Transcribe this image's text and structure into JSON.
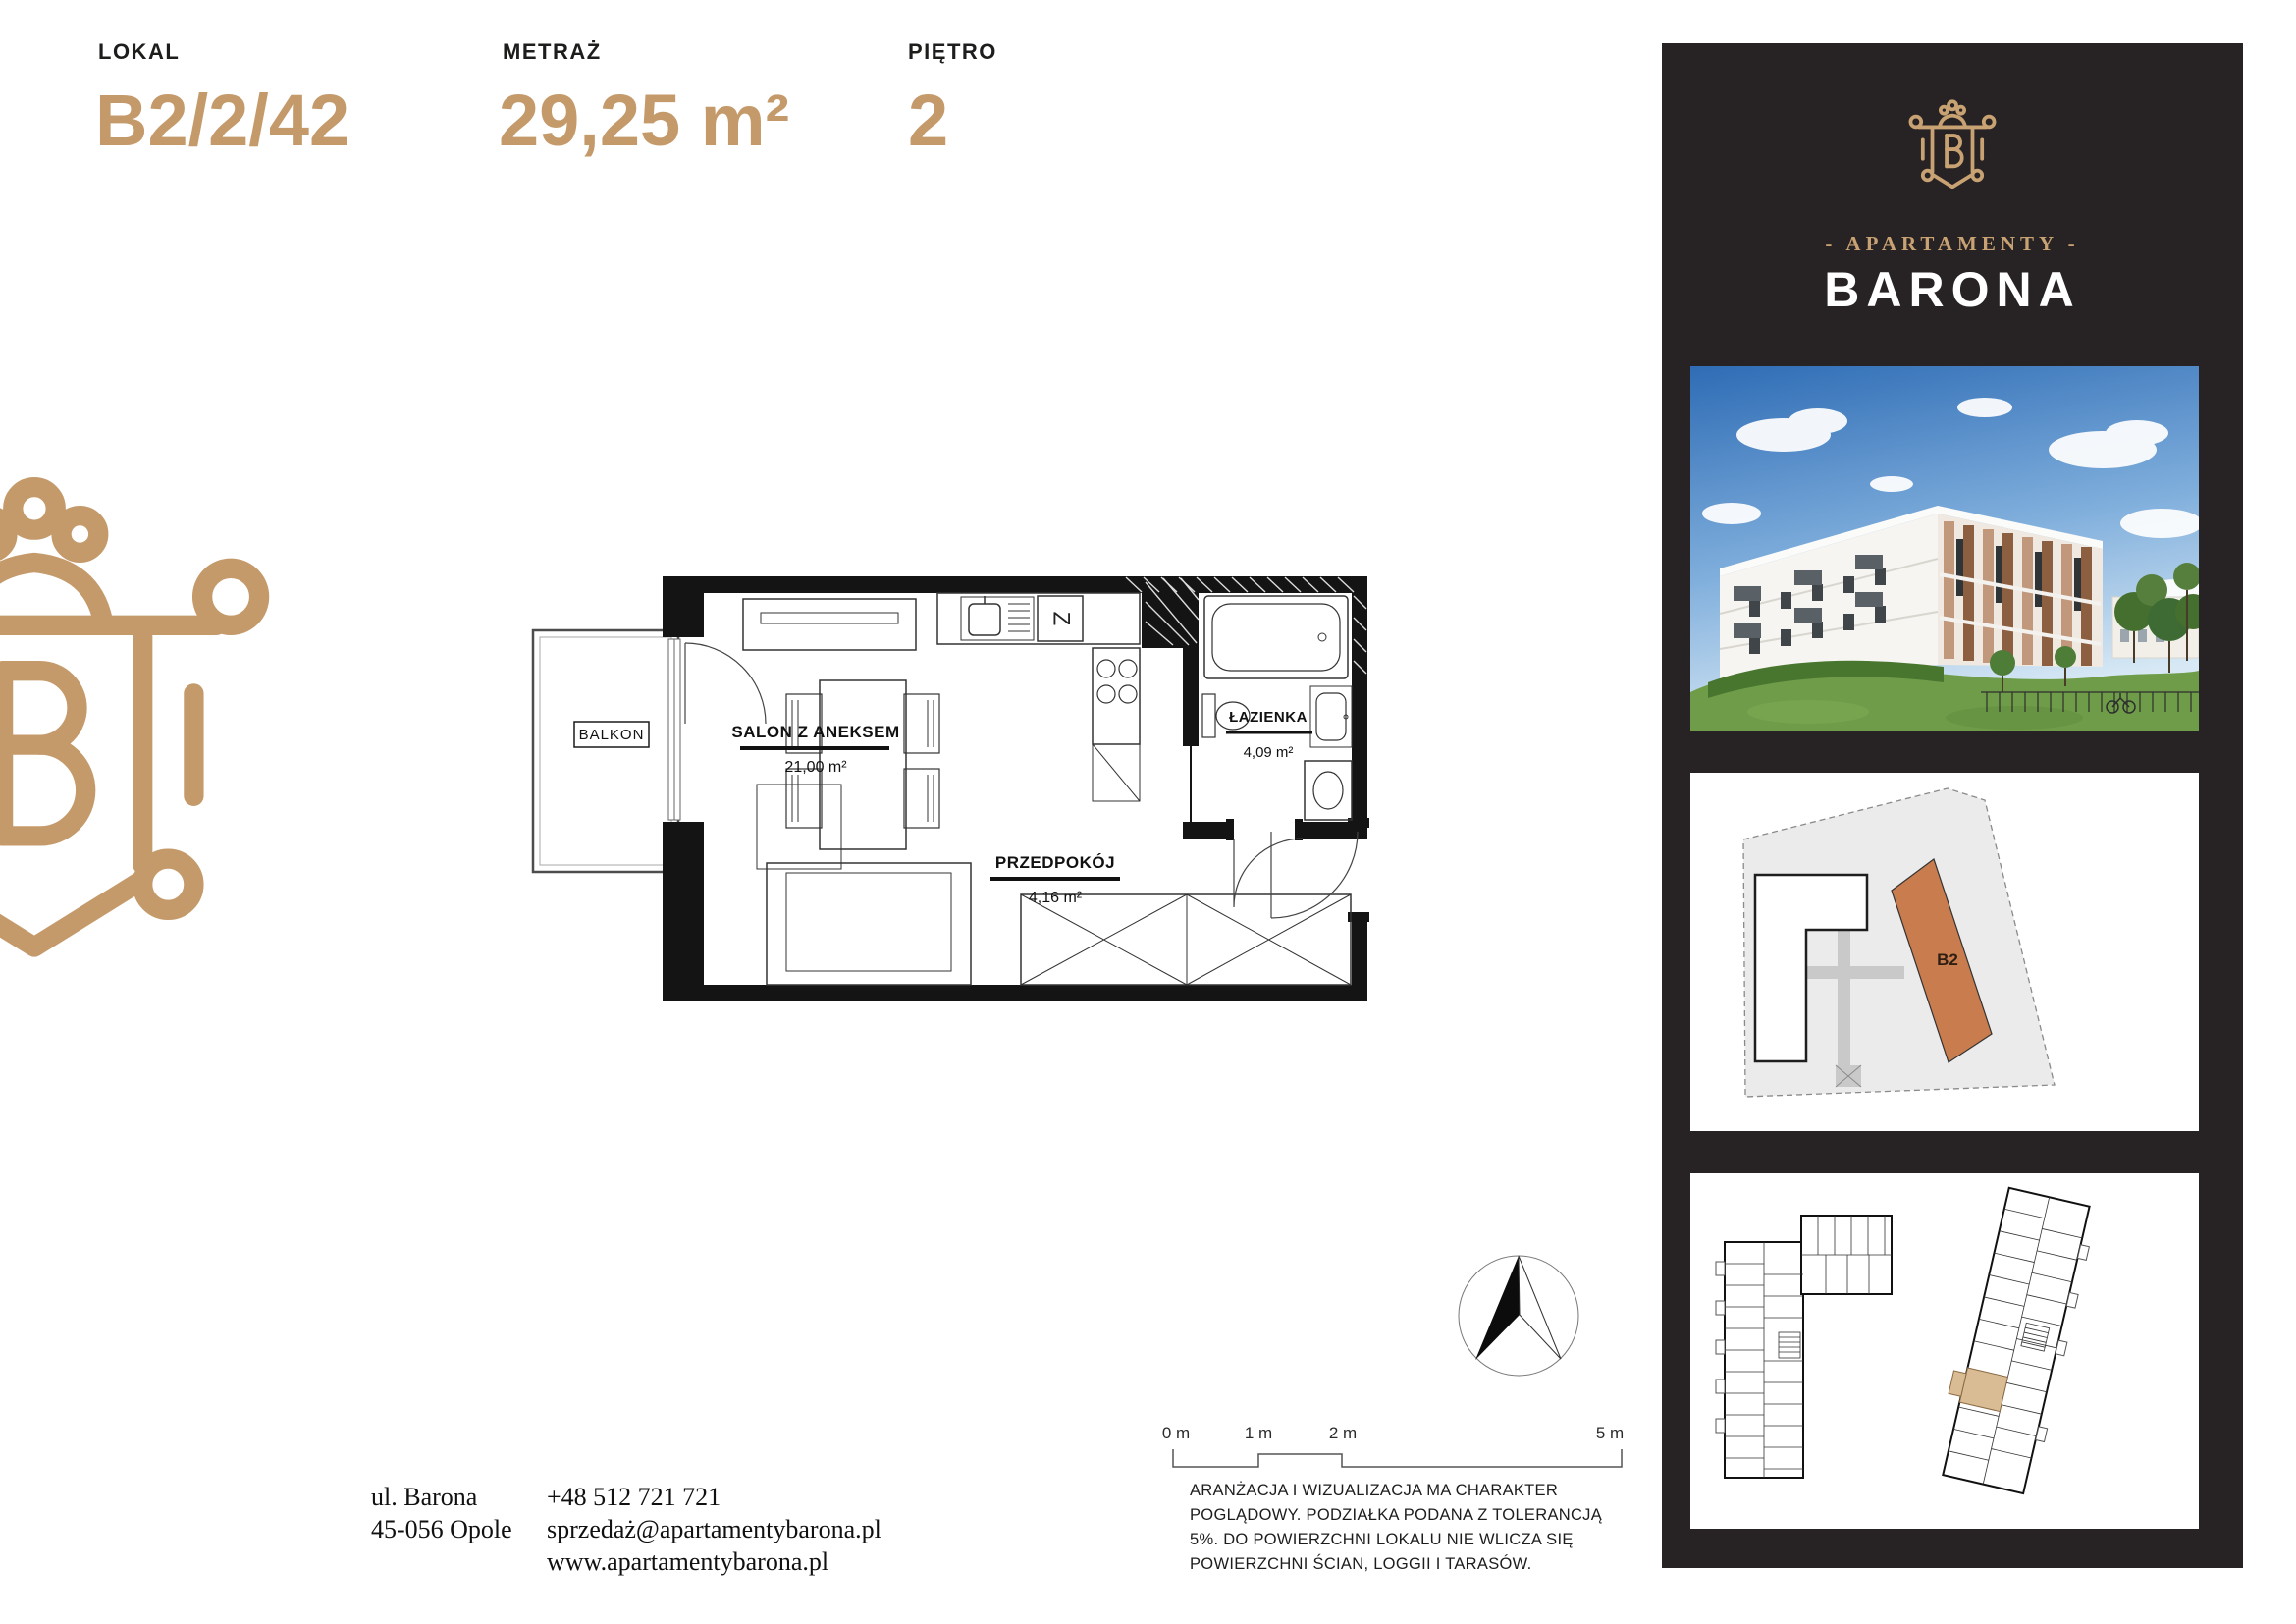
{
  "header": {
    "lokal_label": "LOKAL",
    "lokal_value": "B2/2/42",
    "metraz_label": "METRAŻ",
    "metraz_value": "29,25 m²",
    "pietro_label": "PIĘTRO",
    "pietro_value": "2"
  },
  "plan": {
    "balcony_label": "BALKON",
    "kitchen_symbol": "Z",
    "rooms": [
      {
        "name": "SALON Z ANEKSEM",
        "area": "21,00 m²"
      },
      {
        "name": "ŁAZIENKA",
        "area": "4,09 m²"
      },
      {
        "name": "PRZEDPOKÓJ",
        "area": "4,16 m²"
      }
    ]
  },
  "scalebar": {
    "labels": [
      "0 m",
      "1 m",
      "2 m",
      "5 m"
    ]
  },
  "compass": {
    "description": "north-arrow"
  },
  "disclaimer": "ARANŻACJA I WIZUALIZACJA MA CHARAKTER\nPOGLĄDOWY. PODZIAŁKA PODANA Z TOLERANCJĄ\n5%. DO POWIERZCHNI LOKALU NIE WLICZA SIĘ\nPOWIERZCHNI ŚCIAN, LOGGII I TARASÓW.",
  "contact": {
    "address_line1": "ul. Barona",
    "address_line2": "45-056 Opole",
    "phone": "+48 512 721 721",
    "email": "sprzedaż@apartamentybarona.pl",
    "website": "www.apartamentybarona.pl"
  },
  "sidebar": {
    "brand_tagline": "- APARTAMENTY -",
    "brand_name": "BARONA",
    "siteplan_building_label": "B2"
  },
  "colors": {
    "accent_tan": "#c59a6b",
    "logo_gold": "#c8a272",
    "siteplan_building_orange": "#c97c4d",
    "unit_highlight": "#d9bc94",
    "sidebar_background": "#272224"
  }
}
